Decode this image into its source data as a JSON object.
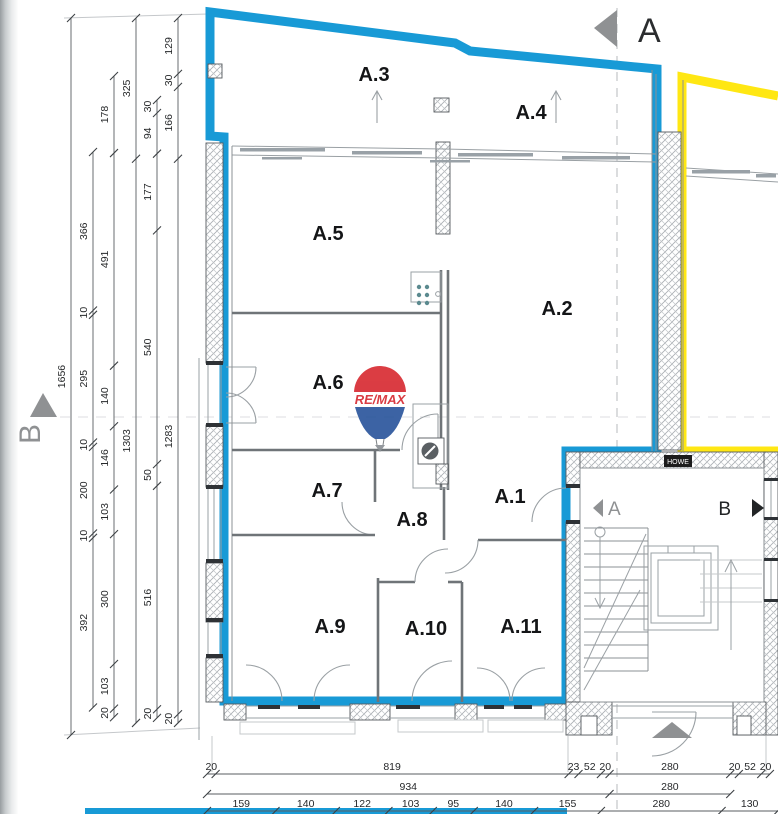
{
  "colors": {
    "highlight_blue": "#189AD6",
    "highlight_yellow": "#FFE713",
    "marker_gray": "#8F9193",
    "logo_red": "#D7282F",
    "logo_blue": "#27539B"
  },
  "markers": {
    "section_top": "A",
    "section_side": "B",
    "stair_view_left": "A",
    "stair_view_right": "B"
  },
  "logo": {
    "text": "RE/MAX"
  },
  "stair_badge": "HOWE",
  "rooms": [
    {
      "label": "A.3",
      "x": 374,
      "y": 81
    },
    {
      "label": "A.4",
      "x": 531,
      "y": 119
    },
    {
      "label": "A.5",
      "x": 328,
      "y": 240
    },
    {
      "label": "A.2",
      "x": 557,
      "y": 315
    },
    {
      "label": "A.6",
      "x": 328,
      "y": 389
    },
    {
      "label": "A.7",
      "x": 327,
      "y": 497
    },
    {
      "label": "A.8",
      "x": 412,
      "y": 526
    },
    {
      "label": "A.1",
      "x": 510,
      "y": 503
    },
    {
      "label": "A.9",
      "x": 330,
      "y": 633
    },
    {
      "label": "A.10",
      "x": 426,
      "y": 635
    },
    {
      "label": "A.11",
      "x": 521,
      "y": 633
    }
  ],
  "room_arrows": [
    {
      "x": 377,
      "y1": 123,
      "y2": 92
    },
    {
      "x": 556,
      "y1": 123,
      "y2": 92
    }
  ],
  "dims": {
    "scale_v": 0.433,
    "scale_h": 0.431,
    "left_chains": [
      {
        "x": 71,
        "start_y": 18,
        "segments": [
          1656
        ]
      },
      {
        "x": 93,
        "start_y": 152,
        "segments": [
          366,
          10,
          295,
          10,
          200,
          10,
          392
        ]
      },
      {
        "x": 114,
        "start_y": 76,
        "segments": [
          178,
          491,
          140,
          146,
          103,
          300,
          103,
          20
        ]
      },
      {
        "x": 136,
        "start_y": 18,
        "segments": [
          325,
          1303
        ]
      },
      {
        "x": 157,
        "start_y": 100,
        "segments": [
          30,
          94,
          177,
          540,
          50,
          516,
          20
        ]
      },
      {
        "x": 178,
        "start_y": 18,
        "segments": [
          129,
          30,
          166,
          1283,
          20
        ]
      }
    ],
    "bottom_rows": [
      {
        "y": 770,
        "start_x": 207,
        "segments": [
          20,
          819,
          23,
          52,
          20,
          280,
          20,
          52,
          20
        ]
      },
      {
        "y": 790,
        "start_x": 207,
        "segments": [
          934,
          280
        ]
      },
      {
        "y": 807,
        "start_x": 207,
        "segments": [
          159,
          140,
          122,
          103,
          95,
          140,
          155,
          280,
          130
        ]
      }
    ]
  }
}
